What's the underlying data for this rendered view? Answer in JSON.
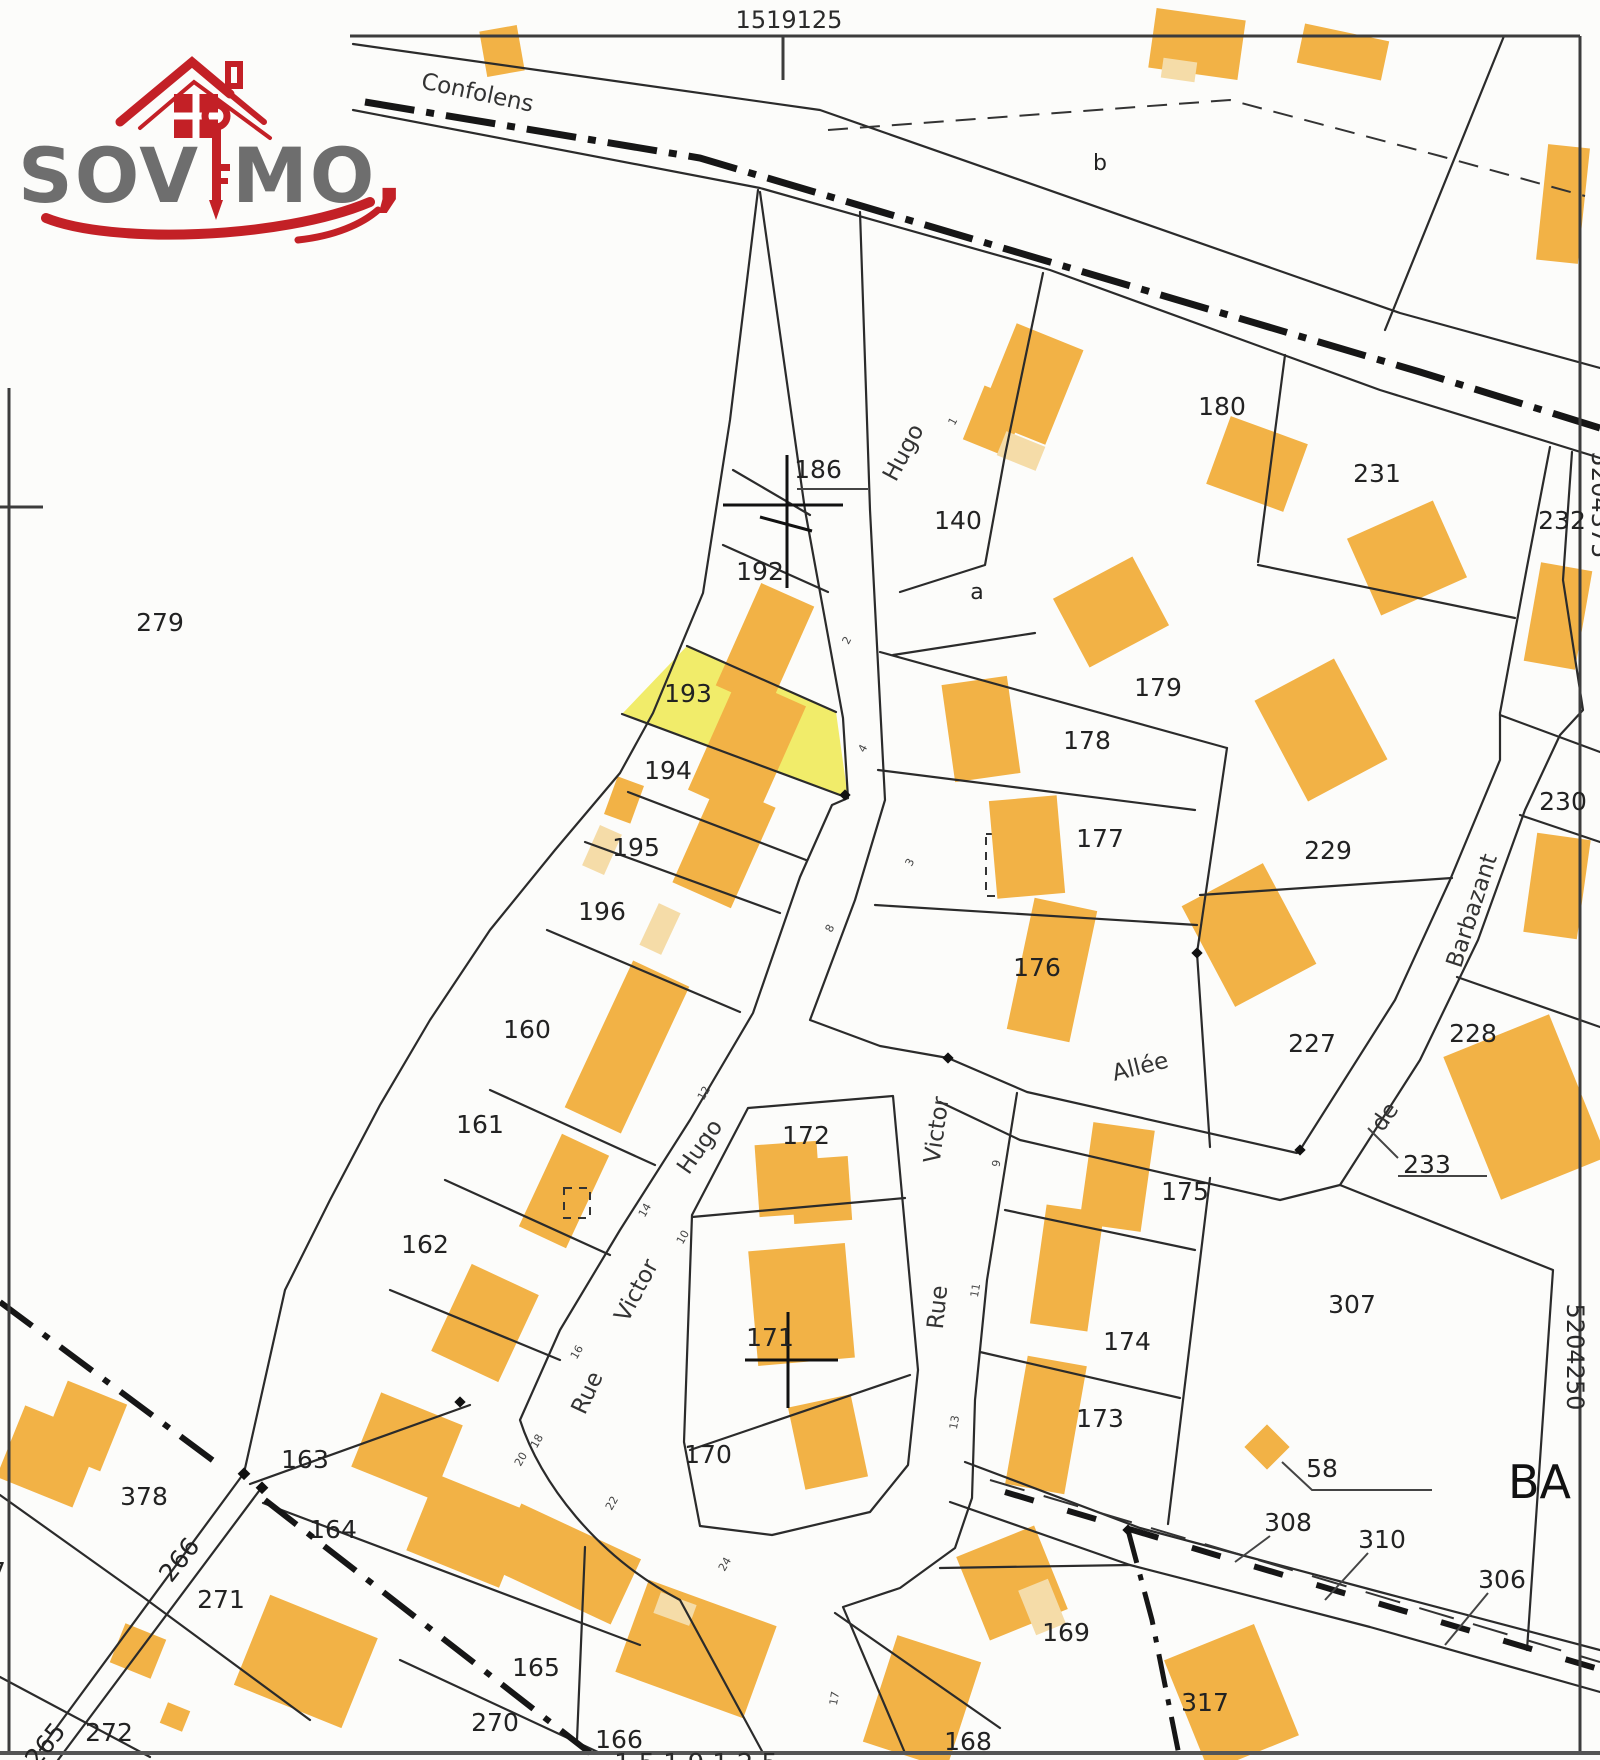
{
  "logo": {
    "part1": "SOV",
    "part2": "MO",
    "comma": ","
  },
  "coordinates": {
    "top": "1519125",
    "bottom": "1519125",
    "right_upper": "5204375",
    "right_lower": "5204250"
  },
  "sheet_label": "BA",
  "section_letters": {
    "a": "a",
    "b": "b"
  },
  "streets": {
    "confolens": "Confolens",
    "hugo_north": "Hugo",
    "hugo_left": "Hugo",
    "victor_left": "Victor",
    "rue_left": "Rue",
    "victor_right": "Victor",
    "rue_right": "Rue",
    "allee": "Allée",
    "de": "de",
    "barbazant": "Barbazant"
  },
  "parcels": {
    "p279": "279",
    "p186": "186",
    "p192": "192",
    "p193": "193",
    "p194": "194",
    "p195": "195",
    "p196": "196",
    "p160": "160",
    "p161": "161",
    "p162": "162",
    "p163": "163",
    "p164": "164",
    "p165": "165",
    "p166": "166",
    "p270": "270",
    "p271": "271",
    "p272": "272",
    "p378": "378",
    "p265": "265",
    "p266": "266",
    "p7": "7",
    "p170": "170",
    "p171": "171",
    "p172": "172",
    "p173": "173",
    "p174": "174",
    "p175": "175",
    "p176": "176",
    "p177": "177",
    "p178": "178",
    "p179": "179",
    "p140": "140",
    "p180": "180",
    "p231": "231",
    "p232": "232",
    "p229": "229",
    "p230": "230",
    "p227": "227",
    "p228": "228",
    "p233": "233",
    "p307": "307",
    "p308": "308",
    "p310": "310",
    "p306": "306",
    "p317": "317",
    "p58": "58",
    "p168": "168",
    "p169": "169"
  },
  "house_numbers": {
    "n1": "1",
    "n2": "2",
    "n3": "3",
    "n4": "4",
    "n8": "8",
    "n9": "9",
    "n10": "10",
    "n11": "11",
    "n12": "12",
    "n13": "13",
    "n14": "14",
    "n16": "16",
    "n17": "17",
    "n18": "18",
    "n20": "20",
    "n22": "22",
    "n24": "24"
  },
  "colors": {
    "building": "#F2B246",
    "building_light": "#F5DCA8",
    "highlight": "#F1EC6A",
    "line": "#2b2b2b",
    "brand_red": "#C32026",
    "brand_gray": "#6E6E6E"
  }
}
